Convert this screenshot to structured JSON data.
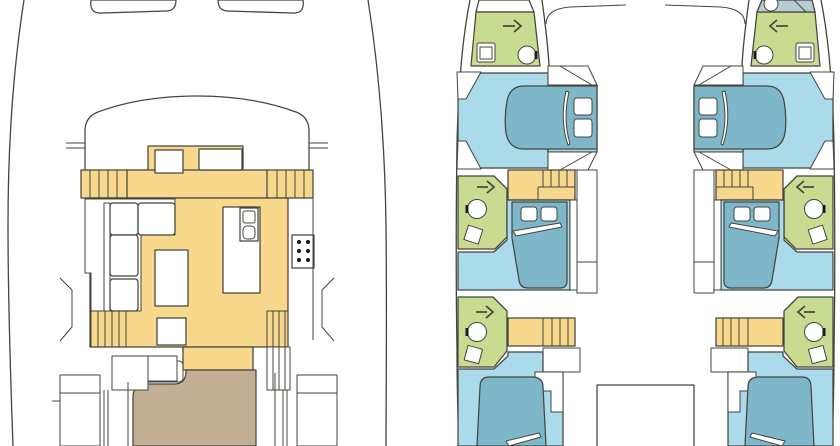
{
  "page": {
    "background": "#ffffff"
  },
  "colors": {
    "line": "#45453c",
    "white": "#ffffff",
    "furniture_yellow": "#f7d88c",
    "cockpit_tan": "#c2ae92",
    "cabin_floor_blue": "#abdbea",
    "bed_blue": "#7eb7ca",
    "bathroom_green": "#c8db90",
    "foredeck_gray": "#b6ccd4",
    "black": "#1c1c1c"
  },
  "panels": {
    "main_deck": {
      "id": "main-deck-plan",
      "features": [
        "bow-sunpads",
        "coachroof",
        "side-seat-bands",
        "saloon-sofa",
        "dinette-table",
        "galley-sink",
        "stove",
        "companionway-steps",
        "aft-cockpit"
      ]
    },
    "lower_deck": {
      "id": "lower-deck-plan",
      "hulls": [
        "port",
        "starboard"
      ],
      "cabins_per_hull": 3,
      "bathrooms_per_hull": 3,
      "stairs_per_hull": 2
    }
  },
  "icons": {
    "door_arrow_port": "right-arrow",
    "door_arrow_starboard": "left-arrow",
    "toilet": "circle-with-seat-mark",
    "sink": "square-basin",
    "stove": "six-burner-dots",
    "shower": "circle"
  }
}
